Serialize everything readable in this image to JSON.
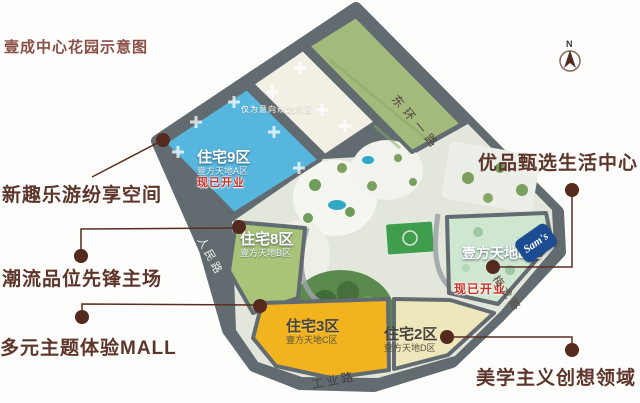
{
  "page_title": "壹成中心花园示意图",
  "callouts": {
    "left": [
      "新趣乐游纷享空间",
      "潮流品位先锋主场",
      "多元主题体验MALL"
    ],
    "right": [
      "优品甄选生活中心",
      "美学主义创想领域"
    ]
  },
  "map": {
    "zones": {
      "zone9": {
        "name": "住宅9区",
        "subtitle": "壹方天地A区",
        "status": "现已开业",
        "color": "#56b6dd"
      },
      "zone8": {
        "name": "住宅8区",
        "subtitle": "壹方天地B区",
        "color": "#a9c378"
      },
      "zone3": {
        "name": "住宅3区",
        "subtitle": "壹方天地C区",
        "color": "#f2b41e"
      },
      "zone2": {
        "name": "住宅2区",
        "subtitle": "壹方天地D区",
        "color": "#efe7bc"
      },
      "zoneE": {
        "name": "壹方天地E区",
        "status": "现已开业",
        "color": "#cfe7d1"
      },
      "planning_note": "仅为意向规划示意"
    },
    "roads": {
      "northeast": "东环一路",
      "west": "人民路",
      "south": "工业路",
      "east": "梅龙路"
    },
    "compass": "N",
    "badge_sams": "Sam's"
  },
  "palette": {
    "title_color": "#8a5047",
    "callout_brown": "#5e352b",
    "status_red": "#cf2f27",
    "road_gray": "#626b70",
    "sams_blue": "#1c4d92",
    "leader_dot": "#54291e"
  }
}
